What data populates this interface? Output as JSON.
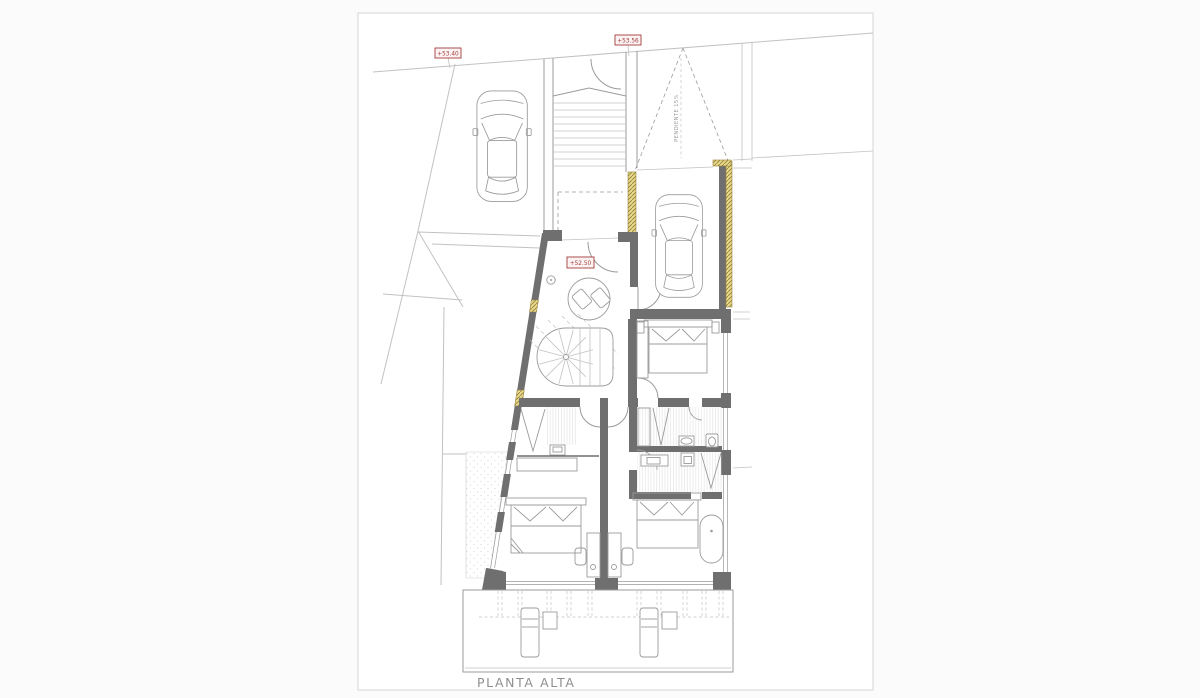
{
  "drawing": {
    "title": "PLANTA ALTA",
    "level_marks": [
      {
        "text": "+53.40"
      },
      {
        "text": "+53.56"
      },
      {
        "text": "+52.50"
      }
    ],
    "ramp_label": "PENDIENTE 15%"
  },
  "colors": {
    "canvas_bg": "#fbfbfb",
    "paper": "#ffffff",
    "page_border": "#d6d6d6",
    "wall": "#6f6f6f",
    "line_light": "#c2c2c2",
    "line_med": "#9b9b9b",
    "accent_red": "#a63c3c",
    "label_bg": "#fbf3f3",
    "hatch_yellow": "#e8d88b",
    "hatch_yellow_line": "#93803a",
    "title_gray": "#8f8f8f"
  }
}
